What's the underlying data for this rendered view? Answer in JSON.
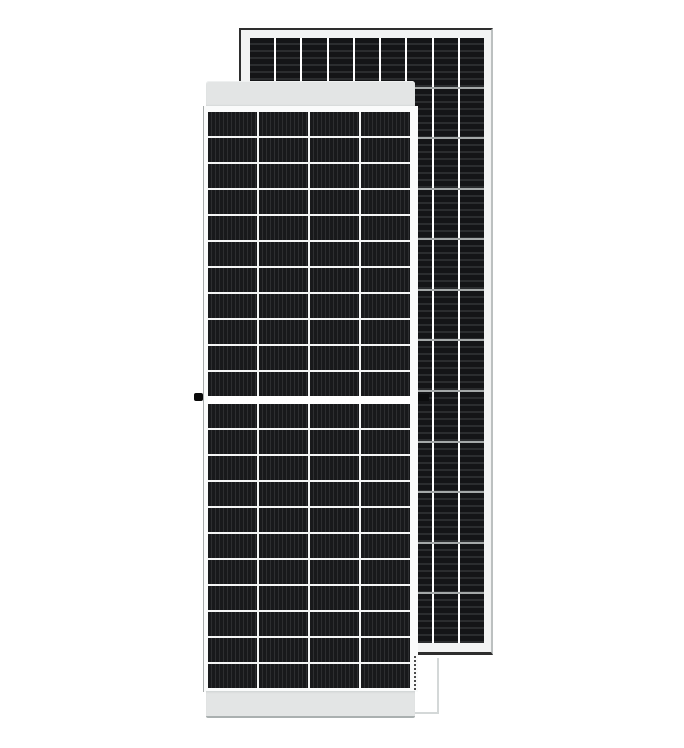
{
  "scene": {
    "type": "product-photo",
    "subject": "Two framed monocrystalline solar panels: front-view panel in foreground, rear-view panel standing behind it",
    "background": "#ffffff"
  },
  "front_panel": {
    "view": "front",
    "orientation": "portrait",
    "columns": 4,
    "halves": 2,
    "rows_per_half": 11,
    "stripe_direction": "vertical",
    "features": [
      "light-gray top frame rail",
      "light-gray bottom frame rail",
      "white cell separators",
      "white half-cut gap across the middle",
      "black grounding lug on left frame edge"
    ]
  },
  "rear_panel": {
    "view": "rear",
    "orientation": "portrait",
    "columns": 9,
    "rows": 12,
    "stripe_direction": "horizontal",
    "features": [
      "white frame",
      "dark outer edge on top, left and bottom",
      "gray horizontal row separators",
      "white vertical column separators",
      "small black lug on right frame area"
    ]
  },
  "colors": {
    "background": "#ffffff",
    "front_rail": "#e3e5e5",
    "front_frame": "#fafbfb",
    "front_cell": "#18191b",
    "front_cell_stripe": "#2d2e30",
    "front_gap": "#f4f5f5",
    "rear_frame": "#f2f3f3",
    "rear_cell": "#141517",
    "rear_cell_stripe": "#2b2d2f",
    "rear_row_separator": "#a4a8a8",
    "rear_edge_dark": "#2e2e2e",
    "rail_edge": "#aab0b0",
    "lug": "#0a0a0a",
    "shadow_line": "#d4d8d8"
  }
}
